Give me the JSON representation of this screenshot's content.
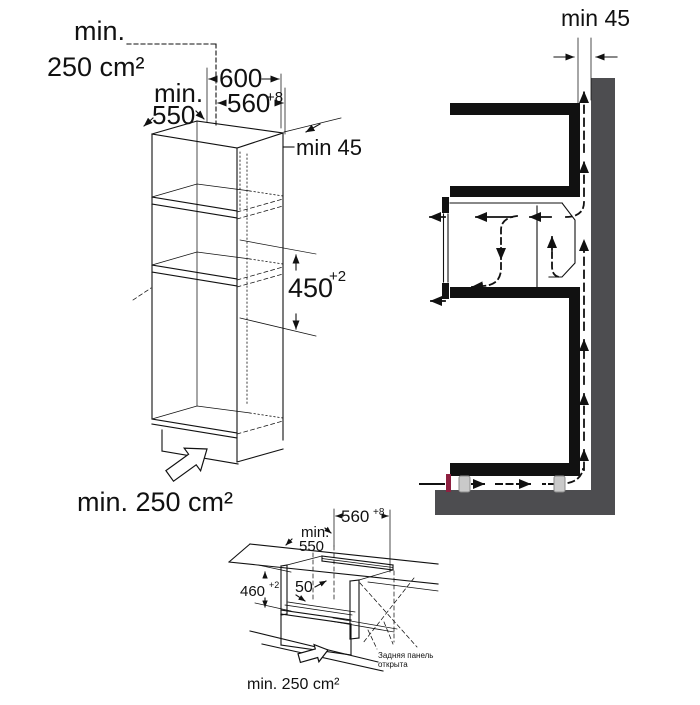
{
  "page": {
    "background": "#ffffff"
  },
  "colors": {
    "line": "#111111",
    "wall": "#4d4d50",
    "foot": "#c9c9c9",
    "foot_stroke": "#8a8a8a",
    "marker_red": "#8e2040"
  },
  "tall_cabinet": {
    "top_vent_label": {
      "line1": "min.",
      "line2": "250 cm²"
    },
    "depth_label": {
      "line1": "min.",
      "line2": "550"
    },
    "outer_width": "600",
    "niche_width": {
      "value": "560",
      "tolerance": "+8"
    },
    "rear_gap": "min 45",
    "niche_height": {
      "value": "450",
      "tolerance": "+2"
    },
    "bottom_vent_label": "min. 250 cm²"
  },
  "side_section": {
    "rear_gap": "min 45"
  },
  "base_cabinet": {
    "niche_width": {
      "value": "560",
      "tolerance": "+8"
    },
    "depth_label": {
      "line1": "min.",
      "line2": "550"
    },
    "niche_height": {
      "value": "460",
      "tolerance": "+2"
    },
    "front_slot": "50",
    "back_panel_note": {
      "line1": "Задняя панель",
      "line2": "открыта"
    },
    "bottom_vent_label": "min. 250 cm²"
  }
}
